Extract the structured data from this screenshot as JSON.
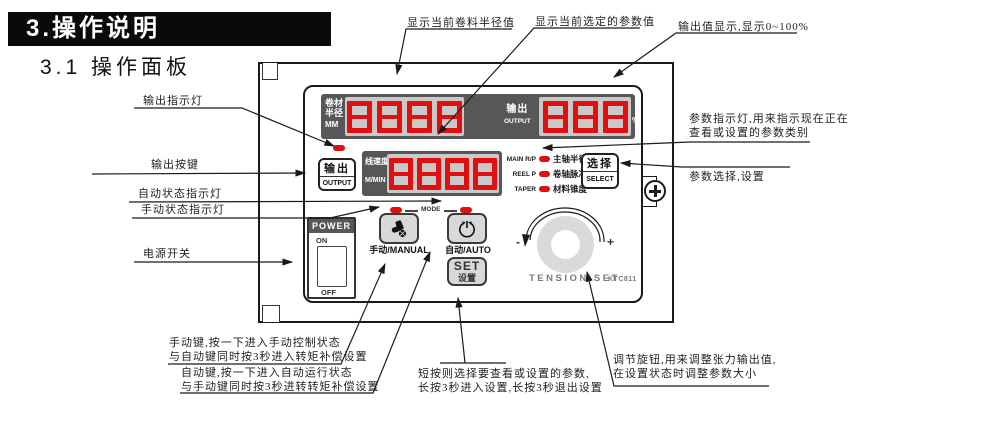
{
  "page": {
    "section_title": "3.操作说明",
    "subsection_title": "3.1 操作面板"
  },
  "panel": {
    "model": "KTC811",
    "displays": {
      "radius": {
        "label_line1": "卷材",
        "label_line2": "半径",
        "unit": "MM",
        "digits": 4
      },
      "output": {
        "label_zh": "输出",
        "label_en": "OUTPUT",
        "unit": "%",
        "digits": 3
      },
      "speed": {
        "label_zh": "线速度",
        "label_en": "M/MIN",
        "digits": 4
      }
    },
    "buttons": {
      "output": {
        "zh": "输出",
        "en": "OUTPUT"
      },
      "select": {
        "zh": "选择",
        "en": "SELECT"
      },
      "manual": {
        "label": "手动/MANUAL"
      },
      "auto": {
        "label": "自动/AUTO"
      },
      "set": {
        "line1": "SET",
        "line2": "设置"
      }
    },
    "param_leds": [
      {
        "en": "MAIN R/P",
        "zh": "主轴半径/脉冲"
      },
      {
        "en": "REEL P",
        "zh": "卷轴脉冲"
      },
      {
        "en": "TAPER",
        "zh": "材料锥度"
      }
    ],
    "mode_label": "MODE",
    "power": {
      "title": "POWER",
      "on": "ON",
      "off": "OFF"
    },
    "knob": {
      "minus": "-",
      "plus": "+",
      "label": "TENSION SET"
    }
  },
  "annotations": {
    "radius_display": "显示当前卷料半径值",
    "param_value_display": "显示当前选定的参数值",
    "output_display": "输出值显示,显示0~100%",
    "param_leds_line1": "参数指示灯,用来指示现在正在",
    "param_leds_line2": "查看或设置的参数类别",
    "select_button": "参数选择,设置",
    "output_led": "输出指示灯",
    "output_button": "输出按键",
    "auto_led": "自动状态指示灯",
    "manual_led": "手动状态指示灯",
    "power_switch": "电源开关",
    "manual_btn_line1": "手动键,按一下进入手动控制状态",
    "manual_btn_line2": "与自动键同时按3秒进入转矩补偿设置",
    "auto_btn_line1": "自动键,按一下进入自动运行状态",
    "auto_btn_line2": "与手动键同时按3秒进转转矩补偿设置",
    "set_btn_line1": "短按则选择要查看或设置的参数,",
    "set_btn_line2": "长按3秒进入设置,长按3秒退出设置",
    "knob_line1": "调节旋钮,用来调整张力输出值,",
    "knob_line2": "在设置状态时调整参数大小"
  },
  "colors": {
    "led_red": "#e01010",
    "bezel_gray": "#57575a",
    "display_window": "#c9c9c9"
  }
}
